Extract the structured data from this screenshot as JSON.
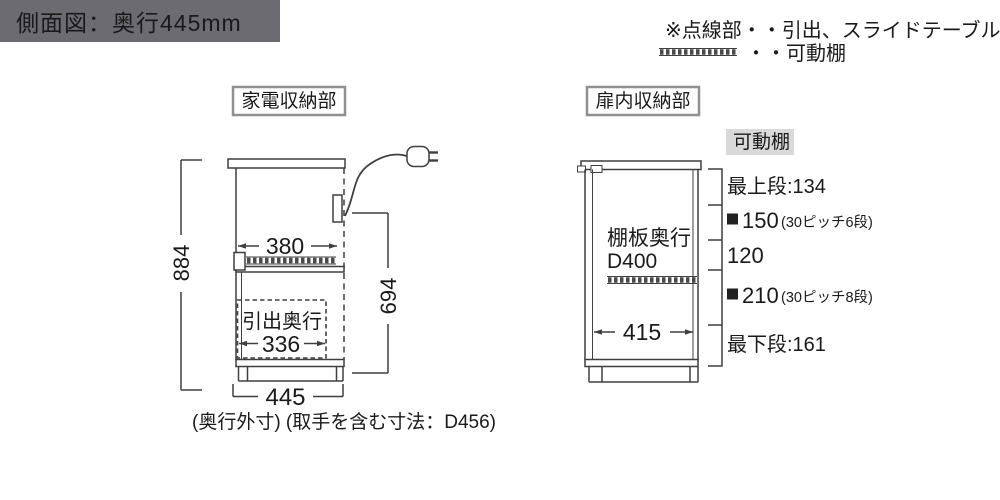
{
  "header": {
    "title": "側面図：奥行445mm"
  },
  "legend": {
    "line1": "※点線部・・引出、スライドテーブル",
    "line2": "・・可動棚",
    "symbol": "hatched-bar"
  },
  "left_unit": {
    "label": "家電収納部",
    "overall_height": "884",
    "upper_inner_width": "380",
    "effective_height": "694",
    "drawer_label": "引出奥行",
    "drawer_depth": "336",
    "depth_outer": "445",
    "caption": "(奥行外寸) (取手を含む寸法：D456)"
  },
  "right_unit": {
    "label": "扉内収納部",
    "shelf_tag": "可動棚",
    "shelf_depth_label": "棚板奥行",
    "shelf_depth_value": "D400",
    "inner_width": "415",
    "sections": [
      {
        "label": "最上段:134"
      },
      {
        "marker": "■",
        "label": "150",
        "note": "(30ピッチ6段)"
      },
      {
        "label": "120"
      },
      {
        "marker": "■",
        "label": "210",
        "note": "(30ピッチ8段)"
      },
      {
        "label": "最下段:161"
      }
    ]
  },
  "icons": {
    "legend_shelf_symbol": "hatched-bar",
    "section_marker": "black-square",
    "plug": "power-plug",
    "drawer_region": "dashed-outline"
  },
  "colors": {
    "header_bg": "#6b6b71",
    "header_text": "#ffffff",
    "tag_bg": "#d9d9d9",
    "line": "#3f3f3f",
    "text": "#1a1a1a",
    "box_border": "#909090"
  }
}
